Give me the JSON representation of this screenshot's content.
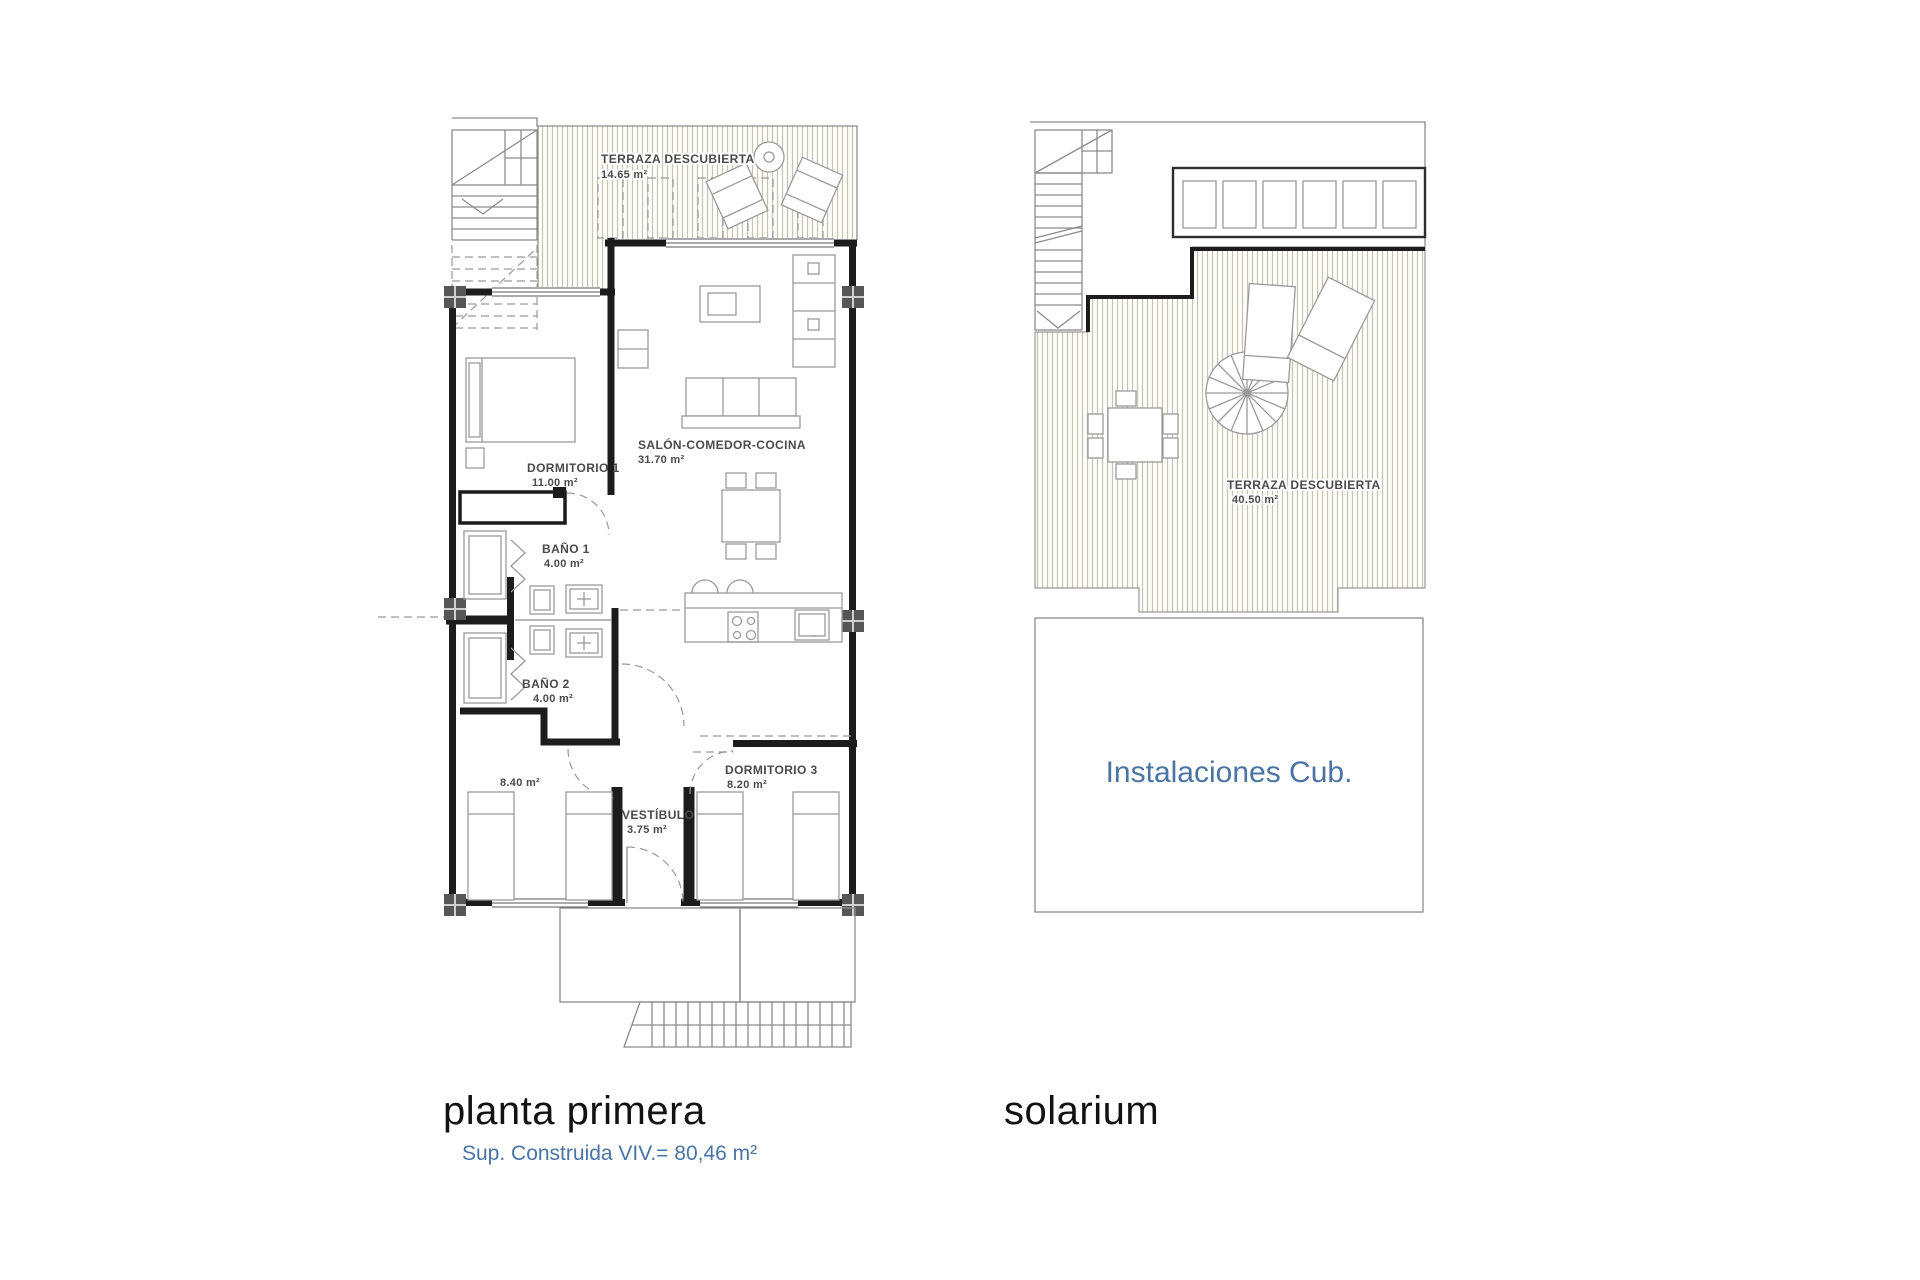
{
  "document": {
    "type": "floor-plan-sheet",
    "background": "#ffffff"
  },
  "colors": {
    "accent_blue": "#4a74a3",
    "wall_black": "#1c1c1c",
    "line_gray": "#8c8c8c",
    "deck_hatch_line": "#c9c4ae",
    "label_gray": "#4a4a4a",
    "column_fill": "#565656"
  },
  "plans": {
    "planta_primera": {
      "title": "planta primera",
      "subtitle": "Sup. Construida VIV.= 80,46 m²",
      "rooms": {
        "terraza": {
          "name": "TERRAZA DESCUBIERTA",
          "area": "14.65 m²"
        },
        "salon": {
          "name": "SALÓN-COMEDOR-COCINA",
          "area": "31.70 m²"
        },
        "dormitorio1": {
          "name": "DORMITORIO 1",
          "area": "11.00 m²"
        },
        "bano1": {
          "name": "BAÑO 1",
          "area": "4.00 m²"
        },
        "bano2": {
          "name": "BAÑO 2",
          "area": "4.00 m²"
        },
        "dormitorio2": {
          "area": "8.40 m²"
        },
        "dormitorio3": {
          "name": "DORMITORIO 3",
          "area": "8.20 m²"
        },
        "vestibulo": {
          "name": "VESTÍBULO",
          "area": "3.75 m²"
        }
      }
    },
    "solarium": {
      "title": "solarium",
      "rooms": {
        "terraza": {
          "name": "TERRAZA DESCUBIERTA",
          "area": "40.50 m²"
        },
        "instalaciones": {
          "name": "Instalaciones Cub."
        }
      }
    }
  }
}
